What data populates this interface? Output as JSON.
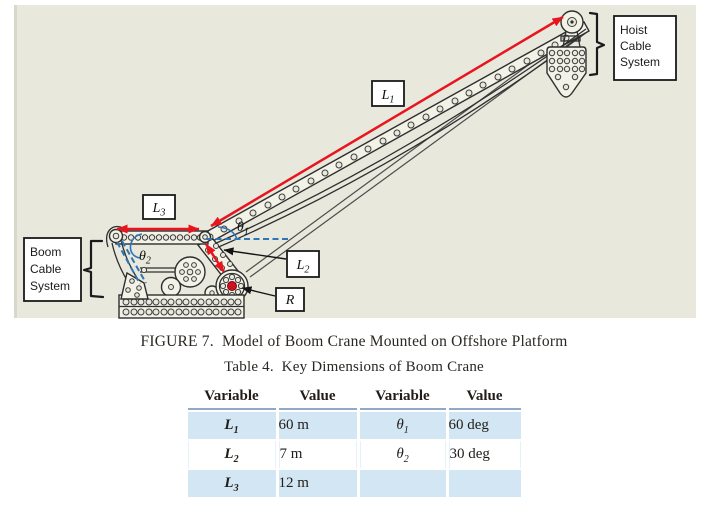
{
  "figure": {
    "background_color": "#e9e8dd",
    "arrow_color": "#e8141e",
    "reference_color": "#2f75b5",
    "labels": {
      "L1": {
        "base": "L",
        "sub": "1"
      },
      "L2": {
        "base": "L",
        "sub": "2"
      },
      "L3": {
        "base": "L",
        "sub": "3"
      },
      "theta1": {
        "base": "θ",
        "sub": "1"
      },
      "theta2": {
        "base": "θ",
        "sub": "2"
      },
      "R": "R"
    },
    "callouts": {
      "hoist": [
        "Hoist",
        "Cable",
        "System"
      ],
      "boom": [
        "Boom",
        "Cable",
        "System"
      ]
    }
  },
  "captions": {
    "figure": "FIGURE 7.  Model of Boom Crane Mounted on Offshore Platform",
    "table": "Table 4.  Key Dimensions of Boom Crane"
  },
  "table": {
    "headers": [
      "Variable",
      "Value",
      "Variable",
      "Value"
    ],
    "rows": [
      {
        "var1": {
          "base": "L",
          "sub": "1"
        },
        "val1": "60 m",
        "var2": {
          "base": "θ",
          "sub": "1"
        },
        "val2": "60 deg"
      },
      {
        "var1": {
          "base": "L",
          "sub": "2"
        },
        "val1": "7 m",
        "var2": {
          "base": "θ",
          "sub": "2"
        },
        "val2": "30 deg"
      },
      {
        "var1": {
          "base": "L",
          "sub": "3"
        },
        "val1": "12 m",
        "var2": null,
        "val2": ""
      }
    ]
  }
}
